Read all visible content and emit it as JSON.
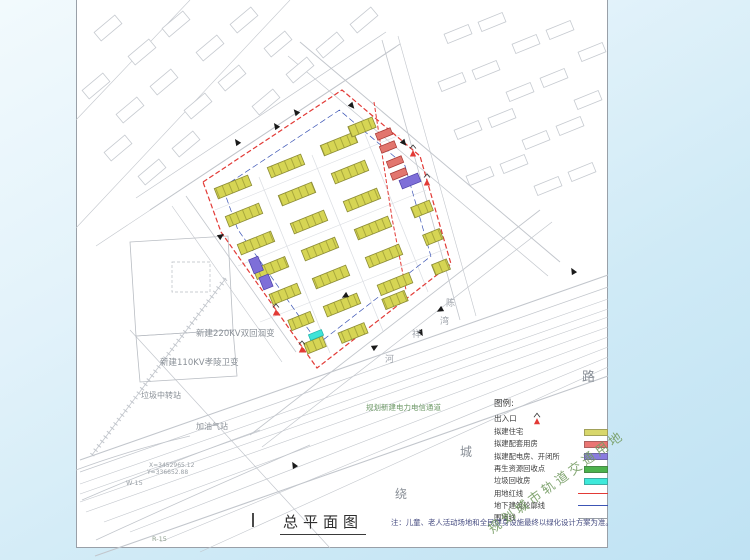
{
  "title": {
    "text": "总平面图"
  },
  "note": {
    "text": "注：儿童、老人活动场地和全民健身设施最终以绿化设计方案为准。"
  },
  "watermark": {
    "text": "规划城市轨道交通用地"
  },
  "legend": {
    "title": "图例:",
    "entrance_label": "出入口",
    "items": [
      {
        "label": "拟建住宅",
        "type": "swatch",
        "color": "#d8d76b"
      },
      {
        "label": "拟建配套用房",
        "type": "swatch",
        "color": "#ea7673"
      },
      {
        "label": "拟建配电房、开闭所",
        "type": "swatch",
        "color": "#897cdf"
      },
      {
        "label": "再生资源回收点",
        "type": "swatch",
        "color": "#4cb24c"
      },
      {
        "label": "垃圾回收房",
        "type": "swatch",
        "color": "#3ee9da"
      },
      {
        "label": "用地红线",
        "type": "line",
        "color": "#e23a36",
        "weight": 1.4
      },
      {
        "label": "地下建筑轮廓线",
        "type": "line",
        "color": "#3c55b5",
        "weight": 1.4
      },
      {
        "label": "围墙线",
        "type": "line",
        "color": "#9aa0a6",
        "weight": 0.8
      }
    ]
  },
  "annotations": [
    {
      "text": "新建220KV双回洄变",
      "x": 196,
      "y": 330,
      "size": 8.5,
      "color": "#8a9097"
    },
    {
      "text": "新建110KV孝陵卫变",
      "x": 160,
      "y": 359,
      "size": 8.5,
      "color": "#8a9097"
    },
    {
      "text": "垃圾中转站",
      "x": 141,
      "y": 392,
      "size": 8,
      "color": "#8a9097"
    },
    {
      "text": "加油气站",
      "x": 196,
      "y": 423,
      "size": 8,
      "color": "#8a9097"
    },
    {
      "text": "规划新建电力电信通道",
      "x": 366,
      "y": 404,
      "size": 7.5,
      "color": "#6f9a68"
    },
    {
      "text": "X=3452965.12",
      "x": 149,
      "y": 463,
      "size": 6,
      "color": "#9aa0a6"
    },
    {
      "text": "Y=336652.88",
      "x": 147,
      "y": 470,
      "size": 6,
      "color": "#9aa0a6"
    },
    {
      "text": "W-15",
      "x": 126,
      "y": 480,
      "size": 6.5,
      "color": "#9aa0a6"
    },
    {
      "text": "R-15",
      "x": 152,
      "y": 536,
      "size": 6.5,
      "color": "#8fa08f"
    }
  ],
  "road_chars": [
    {
      "ch": "路",
      "x": 582,
      "y": 371,
      "size": 13,
      "color": "#888e96"
    },
    {
      "ch": "城",
      "x": 460,
      "y": 446,
      "size": 12,
      "color": "#888e96"
    },
    {
      "ch": "绕",
      "x": 395,
      "y": 488,
      "size": 12,
      "color": "#888e96"
    },
    {
      "ch": "陈",
      "x": 446,
      "y": 300,
      "size": 9,
      "color": "#a0a5ac"
    },
    {
      "ch": "湾",
      "x": 440,
      "y": 318,
      "size": 9,
      "color": "#a0a5ac"
    },
    {
      "ch": "祥",
      "x": 412,
      "y": 331,
      "size": 9,
      "color": "#a0a5ac"
    },
    {
      "ch": "河",
      "x": 385,
      "y": 356,
      "size": 9,
      "color": "#a0a5ac"
    }
  ],
  "colors": {
    "residential": "#d6d554",
    "residential_stripe": "#a9a83c",
    "residential_stroke": "#8b8b35",
    "support": "#e2766e",
    "support_stroke": "#a83a36",
    "power": "#7e6fd8",
    "power_stroke": "#4a3fa8",
    "garbage": "#3fe3d8",
    "garbage_stroke": "#1fb3ab",
    "redline": "#e23a36",
    "blueline": "#3c55b5",
    "road": "#c2c6cc",
    "context": "#c6cad0",
    "parcel": "#b9bdc3",
    "inner_road": "#dadde2",
    "arrow": "#1a1a1a"
  },
  "plan": {
    "rotation": -22,
    "boundary": [
      [
        203,
        182
      ],
      [
        342,
        90
      ],
      [
        420,
        156
      ],
      [
        451,
        264
      ],
      [
        317,
        368
      ],
      [
        221,
        232
      ]
    ],
    "underground_scale": 0.84,
    "secondary_redline": "374,102 392,218 406,290",
    "residential": [
      [
        233,
        187,
        36
      ],
      [
        286,
        166,
        36
      ],
      [
        339,
        144,
        36
      ],
      [
        362,
        127,
        26
      ],
      [
        244,
        215,
        36
      ],
      [
        297,
        194,
        36
      ],
      [
        350,
        172,
        36
      ],
      [
        256,
        243,
        36
      ],
      [
        309,
        222,
        36
      ],
      [
        362,
        200,
        36
      ],
      [
        271,
        268,
        34
      ],
      [
        320,
        249,
        36
      ],
      [
        373,
        228,
        36
      ],
      [
        422,
        209,
        20
      ],
      [
        285,
        294,
        30
      ],
      [
        331,
        277,
        36
      ],
      [
        384,
        256,
        36
      ],
      [
        433,
        237,
        18
      ],
      [
        301,
        321,
        24
      ],
      [
        342,
        305,
        36
      ],
      [
        395,
        284,
        34
      ],
      [
        441,
        267,
        16
      ],
      [
        315,
        345,
        20
      ],
      [
        353,
        333,
        28
      ],
      [
        395,
        300,
        24
      ]
    ],
    "support": [
      [
        384,
        134
      ],
      [
        388,
        147
      ],
      [
        395,
        162
      ],
      [
        399,
        174
      ]
    ],
    "support_size": [
      16,
      7
    ],
    "power": [
      [
        410,
        181,
        20,
        9
      ],
      [
        256,
        265,
        10,
        15
      ],
      [
        266,
        282,
        10,
        13
      ]
    ],
    "garbage": [
      [
        316,
        335,
        14,
        6
      ]
    ],
    "entrances": [
      [
        413,
        151
      ],
      [
        427,
        180
      ],
      [
        276,
        310
      ],
      [
        302,
        347
      ]
    ],
    "arrows": [
      [
        237,
        142,
        -35
      ],
      [
        221,
        236,
        55
      ],
      [
        276,
        126,
        -35
      ],
      [
        345,
        296,
        -120
      ],
      [
        375,
        347,
        60
      ],
      [
        440,
        310,
        -120
      ],
      [
        421,
        333,
        150
      ],
      [
        404,
        143,
        140
      ],
      [
        352,
        106,
        140
      ],
      [
        296,
        112,
        -40
      ],
      [
        573,
        271,
        -30
      ],
      [
        294,
        465,
        -30
      ]
    ],
    "context_tl": {
      "rot": -40,
      "size": [
        27,
        11
      ],
      "items": [
        [
          108,
          28
        ],
        [
          142,
          52
        ],
        [
          176,
          24
        ],
        [
          210,
          48
        ],
        [
          244,
          20
        ],
        [
          278,
          44
        ],
        [
          96,
          86
        ],
        [
          130,
          110
        ],
        [
          164,
          82
        ],
        [
          198,
          106
        ],
        [
          232,
          78
        ],
        [
          266,
          102
        ],
        [
          118,
          148
        ],
        [
          152,
          172
        ],
        [
          186,
          144
        ],
        [
          300,
          70
        ],
        [
          330,
          45
        ],
        [
          364,
          20
        ]
      ]
    },
    "context_tr": {
      "rot": -22,
      "size": [
        26,
        10
      ],
      "items": [
        [
          458,
          34
        ],
        [
          492,
          22
        ],
        [
          526,
          44
        ],
        [
          560,
          30
        ],
        [
          592,
          52
        ],
        [
          452,
          82
        ],
        [
          486,
          70
        ],
        [
          520,
          92
        ],
        [
          554,
          78
        ],
        [
          588,
          100
        ],
        [
          468,
          130
        ],
        [
          502,
          118
        ],
        [
          536,
          140
        ],
        [
          570,
          126
        ],
        [
          480,
          176
        ],
        [
          514,
          164
        ],
        [
          548,
          186
        ],
        [
          582,
          172
        ]
      ]
    },
    "roads": [
      [
        150,
        210,
        400,
        44,
        1
      ],
      [
        136,
        198,
        386,
        32,
        0.7
      ],
      [
        96,
        246,
        396,
        47,
        0.6
      ],
      [
        300,
        42,
        560,
        262,
        1
      ],
      [
        288,
        56,
        548,
        276,
        0.7
      ],
      [
        382,
        40,
        460,
        320,
        0.8
      ],
      [
        398,
        36,
        476,
        316,
        0.6
      ],
      [
        250,
        435,
        540,
        210,
        0.9
      ],
      [
        262,
        447,
        552,
        222,
        0.7
      ],
      [
        186,
        196,
        296,
        352,
        0.8
      ],
      [
        172,
        206,
        282,
        362,
        0.6
      ],
      [
        130,
        330,
        330,
        548,
        0.7
      ],
      [
        76,
        120,
        190,
        0,
        0.6
      ],
      [
        76,
        228,
        290,
        0,
        0.6
      ]
    ],
    "corridor": [
      [
        80,
        460,
        608,
        275,
        1.1
      ],
      [
        80,
        472,
        608,
        287,
        0.7
      ],
      [
        80,
        484,
        608,
        299,
        0.6
      ],
      [
        80,
        494,
        608,
        309,
        0.6
      ],
      [
        80,
        502,
        608,
        317,
        0.6
      ],
      [
        86,
        512,
        608,
        327,
        0.6
      ],
      [
        104,
        522,
        608,
        337,
        0.6
      ],
      [
        130,
        532,
        608,
        347,
        0.6
      ],
      [
        160,
        542,
        608,
        357,
        0.6
      ],
      [
        200,
        552,
        608,
        367,
        0.6
      ],
      [
        95,
        556,
        608,
        376,
        1.1
      ]
    ],
    "inner_roads": [
      [
        259,
        177,
        330,
        353,
        0.7
      ],
      [
        312,
        155,
        383,
        331,
        0.7
      ],
      [
        365,
        134,
        428,
        292,
        0.7
      ],
      [
        215,
        210,
        400,
        135,
        0.6
      ],
      [
        238,
        266,
        426,
        190,
        0.6
      ],
      [
        260,
        322,
        448,
        248,
        0.6
      ]
    ],
    "rail_ticks": [
      92,
      455,
      226,
      278
    ],
    "curves": [
      "M82,500 Q170,462 260,430",
      "M96,540 Q200,492 310,445",
      "M76,470 Q130,450 190,436"
    ],
    "parcels": [
      [
        [
          130,
          242
        ],
        [
          228,
          236
        ],
        [
          233,
          330
        ],
        [
          136,
          336
        ]
      ],
      [
        [
          136,
          336
        ],
        [
          233,
          330
        ],
        [
          237,
          376
        ],
        [
          140,
          382
        ]
      ]
    ],
    "inner_rect": [
      172,
      262,
      38,
      30
    ]
  }
}
